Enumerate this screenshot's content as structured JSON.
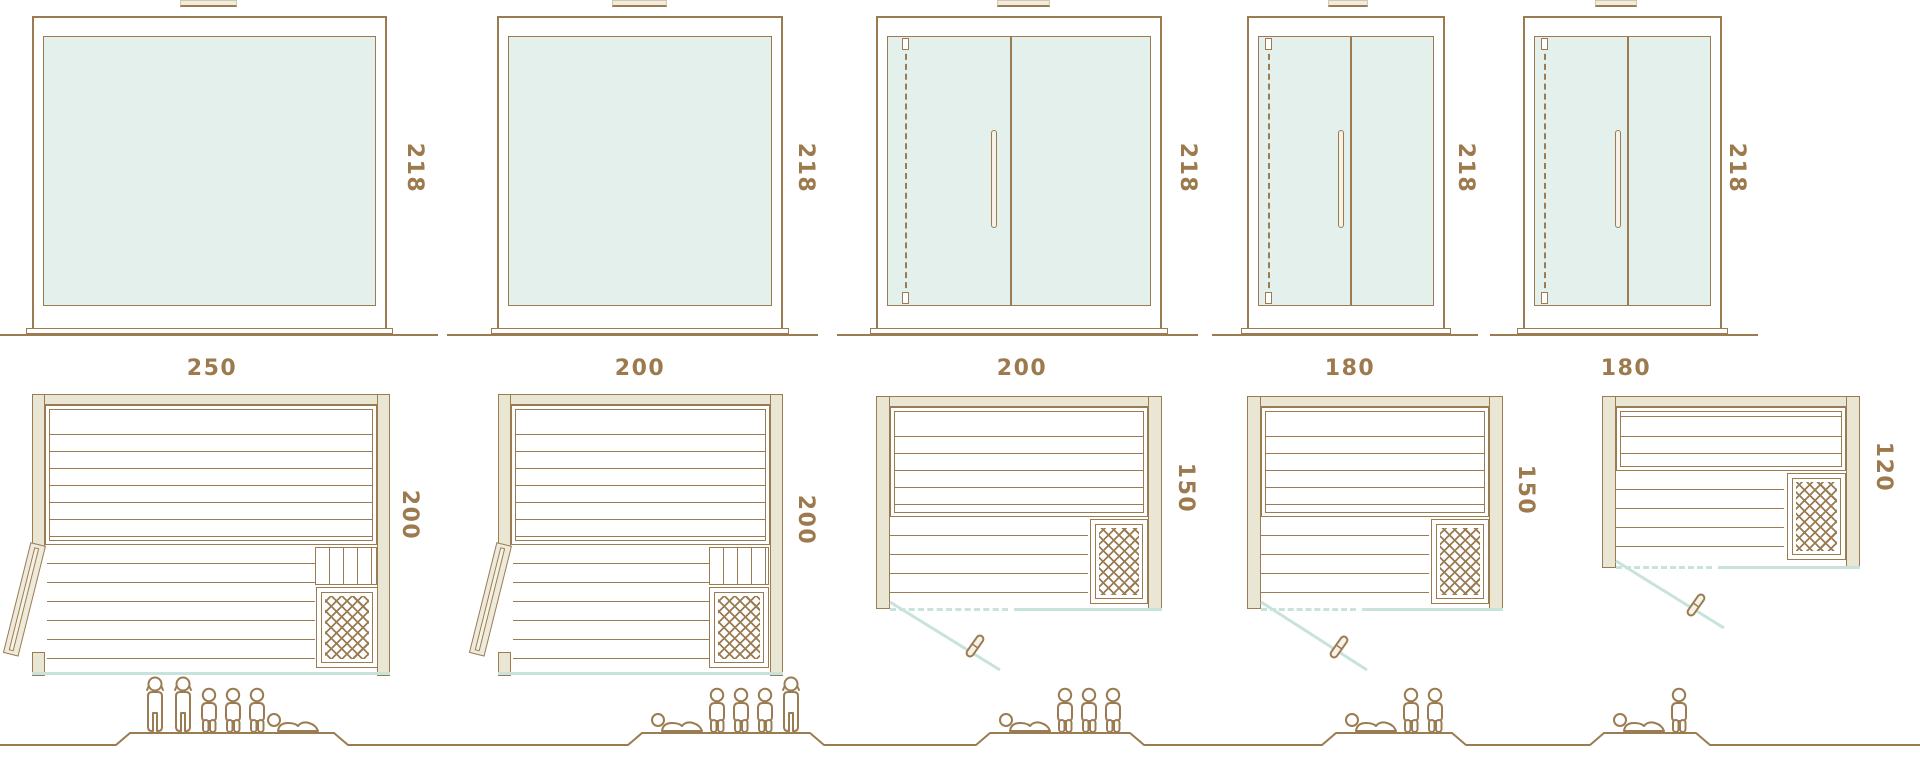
{
  "colors": {
    "outline": "#9b7c52",
    "dimension_text": "#9c7a4e",
    "glass": "#e4f0ec",
    "wood_fill": "#e9e6d3",
    "teal_glass_line": "#c8e2dc"
  },
  "modules": [
    {
      "id": "module-1",
      "width": "250",
      "height": "218",
      "depth": "200",
      "capacity": 6,
      "figures": [
        "standing",
        "standing",
        "seated",
        "seated",
        "seated",
        "reclining"
      ],
      "elevation_door": false,
      "plan_door": "hinged door open at left"
    },
    {
      "id": "module-2",
      "width": "200",
      "height": "218",
      "depth": "200",
      "capacity": 5,
      "figures": [
        "reclining",
        "seated",
        "seated",
        "seated",
        "standing"
      ],
      "elevation_door": false,
      "plan_door": "hinged door open at left"
    },
    {
      "id": "module-3",
      "width": "200",
      "height": "218",
      "depth": "150",
      "capacity": 4,
      "figures": [
        "reclining",
        "seated",
        "seated",
        "seated"
      ],
      "elevation_door": true,
      "plan_door": "glass door swings out front-left"
    },
    {
      "id": "module-4",
      "width": "180",
      "height": "218",
      "depth": "150",
      "capacity": 3,
      "figures": [
        "reclining",
        "seated",
        "seated"
      ],
      "elevation_door": true,
      "plan_door": "glass door swings out front-left"
    },
    {
      "id": "module-5",
      "width": "180",
      "height": "218",
      "depth": "120",
      "capacity": 2,
      "figures": [
        "reclining",
        "seated"
      ],
      "elevation_door": true,
      "plan_door": "glass door swings out front-left"
    }
  ]
}
